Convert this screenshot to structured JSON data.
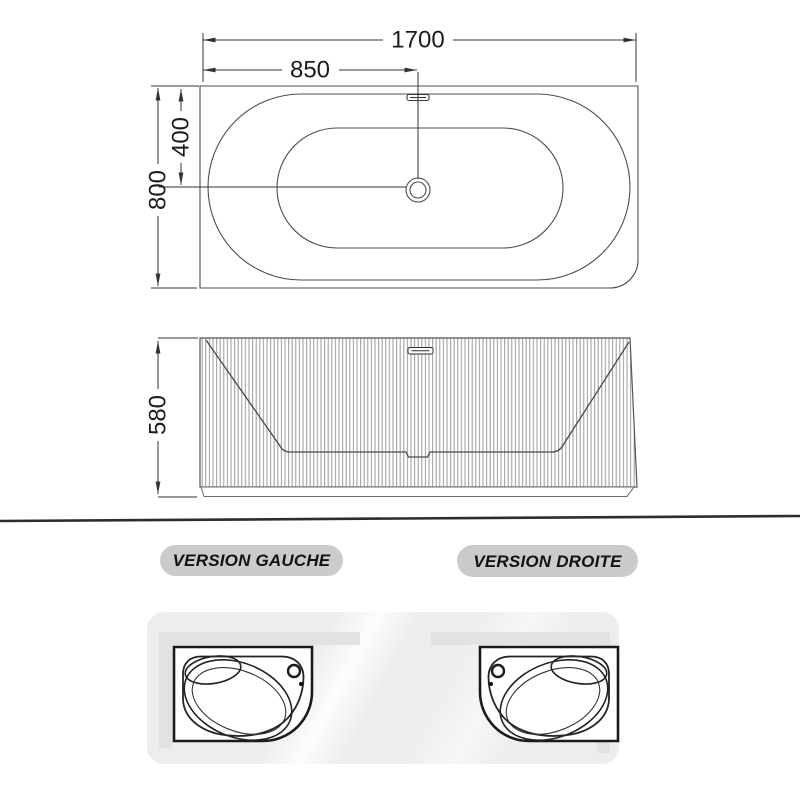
{
  "dimensions": {
    "length": "1700",
    "half_length": "850",
    "drain_offset": "400",
    "width": "800",
    "height": "580"
  },
  "versions": {
    "left": "VERSION GAUCHE",
    "right": "VERSION DROITE"
  },
  "colors": {
    "geometry_line": "#4d4d4d",
    "dimension_line": "#333333",
    "separator": "#2d2d2d",
    "badge_bg": "#cbcbcb",
    "panel_bg": "#ededf0",
    "wall": "#e2e2e5",
    "tub_outline": "#1b1b1b"
  }
}
